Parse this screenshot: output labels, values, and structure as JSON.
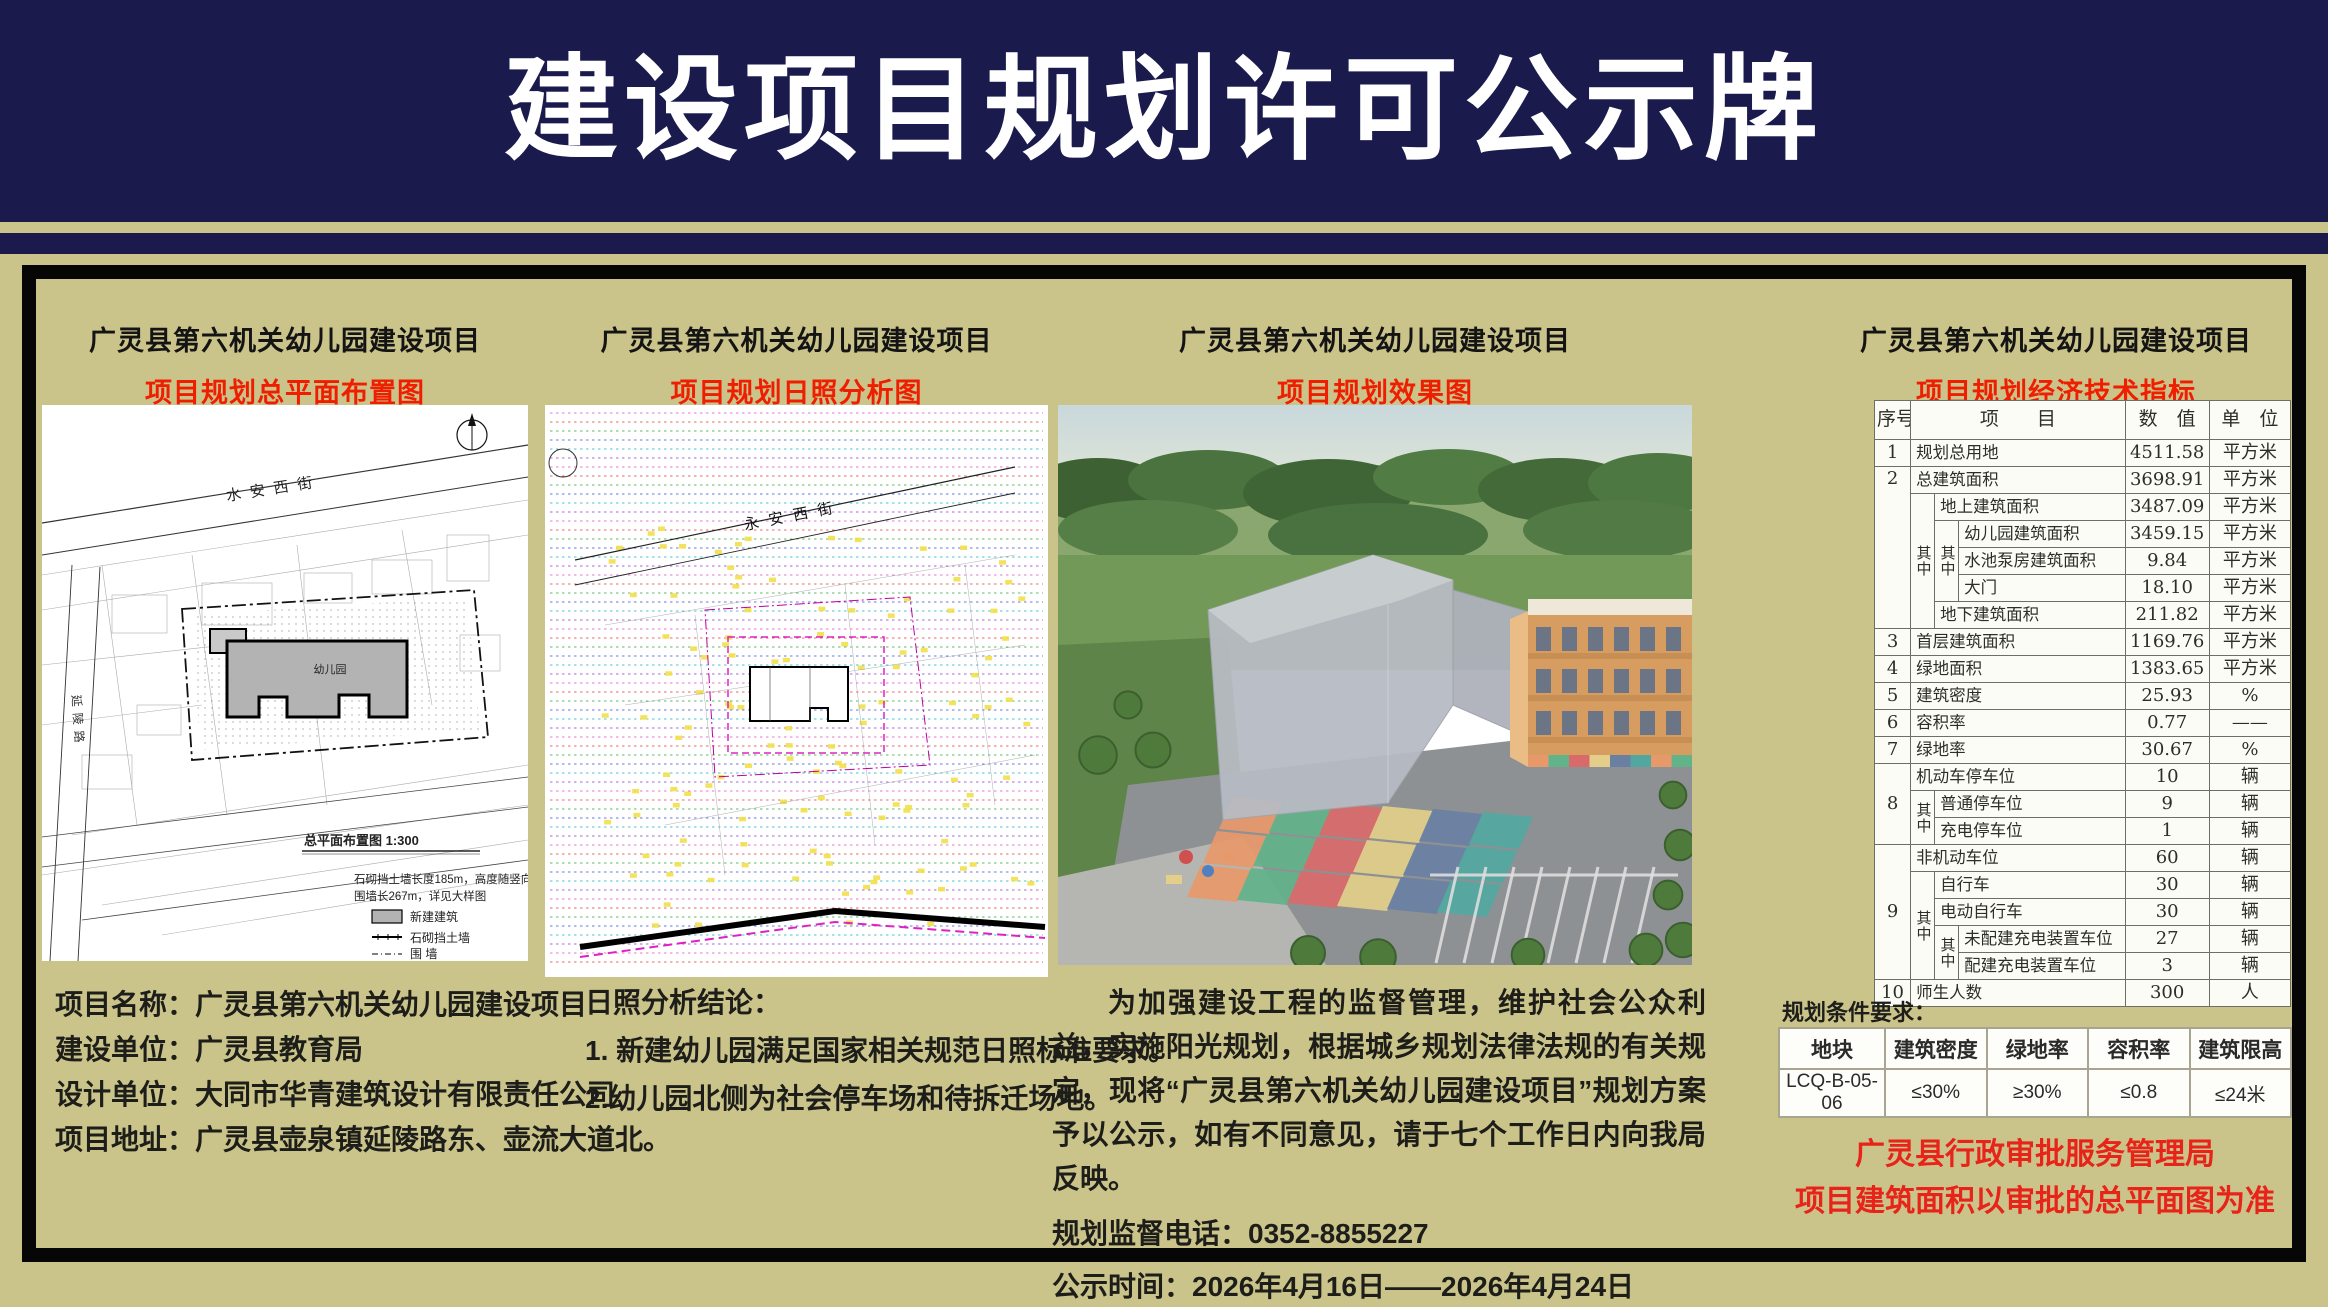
{
  "banner": {
    "title": "建设项目规划许可公示牌"
  },
  "panels": [
    {
      "title": "广灵县第六机关幼儿园建设项目",
      "subtitle": "项目规划总平面布置图"
    },
    {
      "title": "广灵县第六机关幼儿园建设项目",
      "subtitle": "项目规划日照分析图"
    },
    {
      "title": "广灵县第六机关幼儿园建设项目",
      "subtitle": "项目规划效果图"
    },
    {
      "title": "广灵县第六机关幼儿园建设项目",
      "subtitle": "项目规划经济技术指标"
    }
  ],
  "site_plan": {
    "street_top": "水安西街",
    "street_left": "延陵路",
    "building_label": "幼儿园",
    "drawing_title": "总平面布置图  1:300",
    "note_line1": "石砌挡土墙长度185m，高度随竖向标高",
    "note_line2": "围墙长267m，详见大样图",
    "legend_labels": [
      "新建建筑",
      "石砌挡土墙",
      "围  墙"
    ]
  },
  "sunshine": {
    "street": "永安西街"
  },
  "indicators_table": {
    "header": [
      {
        "t": "序号"
      },
      {
        "t": "项　　目",
        "cs": 3
      },
      {
        "t": "数　值"
      },
      {
        "t": "单　位"
      }
    ],
    "rows": [
      [
        {
          "t": "1"
        },
        {
          "t": "规划总用地",
          "cs": 3,
          "cls": "name"
        },
        {
          "t": "4511.58"
        },
        {
          "t": "平方米"
        }
      ],
      [
        {
          "t": "2",
          "rs": 6,
          "cls": "topnum"
        },
        {
          "t": "总建筑面积",
          "cs": 3,
          "cls": "name"
        },
        {
          "t": "3698.91"
        },
        {
          "t": "平方米"
        }
      ],
      [
        {
          "t": "其中",
          "rs": 5,
          "cls": "vert"
        },
        {
          "t": "地上建筑面积",
          "cs": 2,
          "cls": "name"
        },
        {
          "t": "3487.09"
        },
        {
          "t": "平方米"
        }
      ],
      [
        {
          "t": "其中",
          "rs": 3,
          "cls": "vert"
        },
        {
          "t": "幼儿园建筑面积",
          "cls": "name"
        },
        {
          "t": "3459.15"
        },
        {
          "t": "平方米"
        }
      ],
      [
        {
          "t": "水池泵房建筑面积",
          "cls": "name"
        },
        {
          "t": "9.84"
        },
        {
          "t": "平方米"
        }
      ],
      [
        {
          "t": "大门",
          "cls": "name"
        },
        {
          "t": "18.10"
        },
        {
          "t": "平方米"
        }
      ],
      [
        {
          "t": "地下建筑面积",
          "cs": 2,
          "cls": "name"
        },
        {
          "t": "211.82"
        },
        {
          "t": "平方米"
        }
      ],
      [
        {
          "t": "3"
        },
        {
          "t": "首层建筑面积",
          "cs": 3,
          "cls": "name"
        },
        {
          "t": "1169.76"
        },
        {
          "t": "平方米"
        }
      ],
      [
        {
          "t": "4"
        },
        {
          "t": "绿地面积",
          "cs": 3,
          "cls": "name"
        },
        {
          "t": "1383.65"
        },
        {
          "t": "平方米"
        }
      ],
      [
        {
          "t": "5"
        },
        {
          "t": "建筑密度",
          "cs": 3,
          "cls": "name"
        },
        {
          "t": "25.93"
        },
        {
          "t": "%"
        }
      ],
      [
        {
          "t": "6"
        },
        {
          "t": "容积率",
          "cs": 3,
          "cls": "name"
        },
        {
          "t": "0.77"
        },
        {
          "t": "——"
        }
      ],
      [
        {
          "t": "7"
        },
        {
          "t": "绿地率",
          "cs": 3,
          "cls": "name"
        },
        {
          "t": "30.67"
        },
        {
          "t": "%"
        }
      ],
      [
        {
          "t": "8",
          "rs": 3
        },
        {
          "t": "机动车停车位",
          "cs": 3,
          "cls": "name"
        },
        {
          "t": "10"
        },
        {
          "t": "辆"
        }
      ],
      [
        {
          "t": "其中",
          "rs": 2,
          "cls": "vert"
        },
        {
          "t": "普通停车位",
          "cs": 2,
          "cls": "name"
        },
        {
          "t": "9"
        },
        {
          "t": "辆"
        }
      ],
      [
        {
          "t": "充电停车位",
          "cs": 2,
          "cls": "name"
        },
        {
          "t": "1"
        },
        {
          "t": "辆"
        }
      ],
      [
        {
          "t": "9",
          "rs": 5
        },
        {
          "t": "非机动车位",
          "cs": 3,
          "cls": "name"
        },
        {
          "t": "60"
        },
        {
          "t": "辆"
        }
      ],
      [
        {
          "t": "其中",
          "rs": 4,
          "cls": "vert"
        },
        {
          "t": "自行车",
          "cs": 2,
          "cls": "name"
        },
        {
          "t": "30"
        },
        {
          "t": "辆"
        }
      ],
      [
        {
          "t": "电动自行车",
          "cs": 2,
          "cls": "name"
        },
        {
          "t": "30"
        },
        {
          "t": "辆"
        }
      ],
      [
        {
          "t": "其中",
          "rs": 2,
          "cls": "vert"
        },
        {
          "t": "未配建充电装置车位",
          "cls": "name"
        },
        {
          "t": "27"
        },
        {
          "t": "辆"
        }
      ],
      [
        {
          "t": "配建充电装置车位",
          "cls": "name"
        },
        {
          "t": "3"
        },
        {
          "t": "辆"
        }
      ],
      [
        {
          "t": "10"
        },
        {
          "t": "师生人数",
          "cs": 3,
          "cls": "name"
        },
        {
          "t": "300"
        },
        {
          "t": "人"
        }
      ]
    ]
  },
  "info_left": {
    "lines": [
      "项目名称：广灵县第六机关幼儿园建设项目",
      "建设单位：广灵县教育局",
      "设计单位：大同市华青建筑设计有限责任公司",
      "项目地址：广灵县壶泉镇延陵路东、壶流大道北。"
    ]
  },
  "sun_conclusion": {
    "title": "日照分析结论：",
    "items": [
      "1. 新建幼儿园满足国家相关规范日照标准要求。",
      "2.幼儿园北侧为社会停车场和待拆迁场地。"
    ]
  },
  "notice": {
    "paragraph": "为加强建设工程的监督管理，维护社会公众利益，实施阳光规划，根据城乡规划法律法规的有关规定，现将“广灵县第六机关幼儿园建设项目”规划方案予以公示，如有不同意见，请于七个工作日内向我局反映。",
    "phone_line": "规划监督电话：0352-8855227",
    "period_line": "公示时间：2026年4月16日——2026年4月24日"
  },
  "conditions": {
    "title": "规划条件要求：",
    "headers": [
      "地块",
      "建筑密度",
      "绿地率",
      "容积率",
      "建筑限高"
    ],
    "row": [
      "LCQ-B-05-06",
      "≤30%",
      "≥30%",
      "≤0.8",
      "≤24米"
    ]
  },
  "authority": {
    "line1": "广灵县行政审批服务管理局",
    "line2": "项目建筑面积以审批的总平面图为准"
  },
  "palette": {
    "background_khaki": "#cbc48a",
    "banner_navy": "#1a1a4d",
    "subtitle_red": "#f01e00",
    "authority_red": "#e8231a",
    "tile_colors": [
      "#e8996a",
      "#62b38a",
      "#d96a6a",
      "#e3cf8a",
      "#6a80a3",
      "#52a8a0"
    ],
    "sun_row_colors": [
      "#e860c8",
      "#e05050",
      "#40b050",
      "#5060d8",
      "#30b8c8",
      "#9850d0"
    ]
  }
}
